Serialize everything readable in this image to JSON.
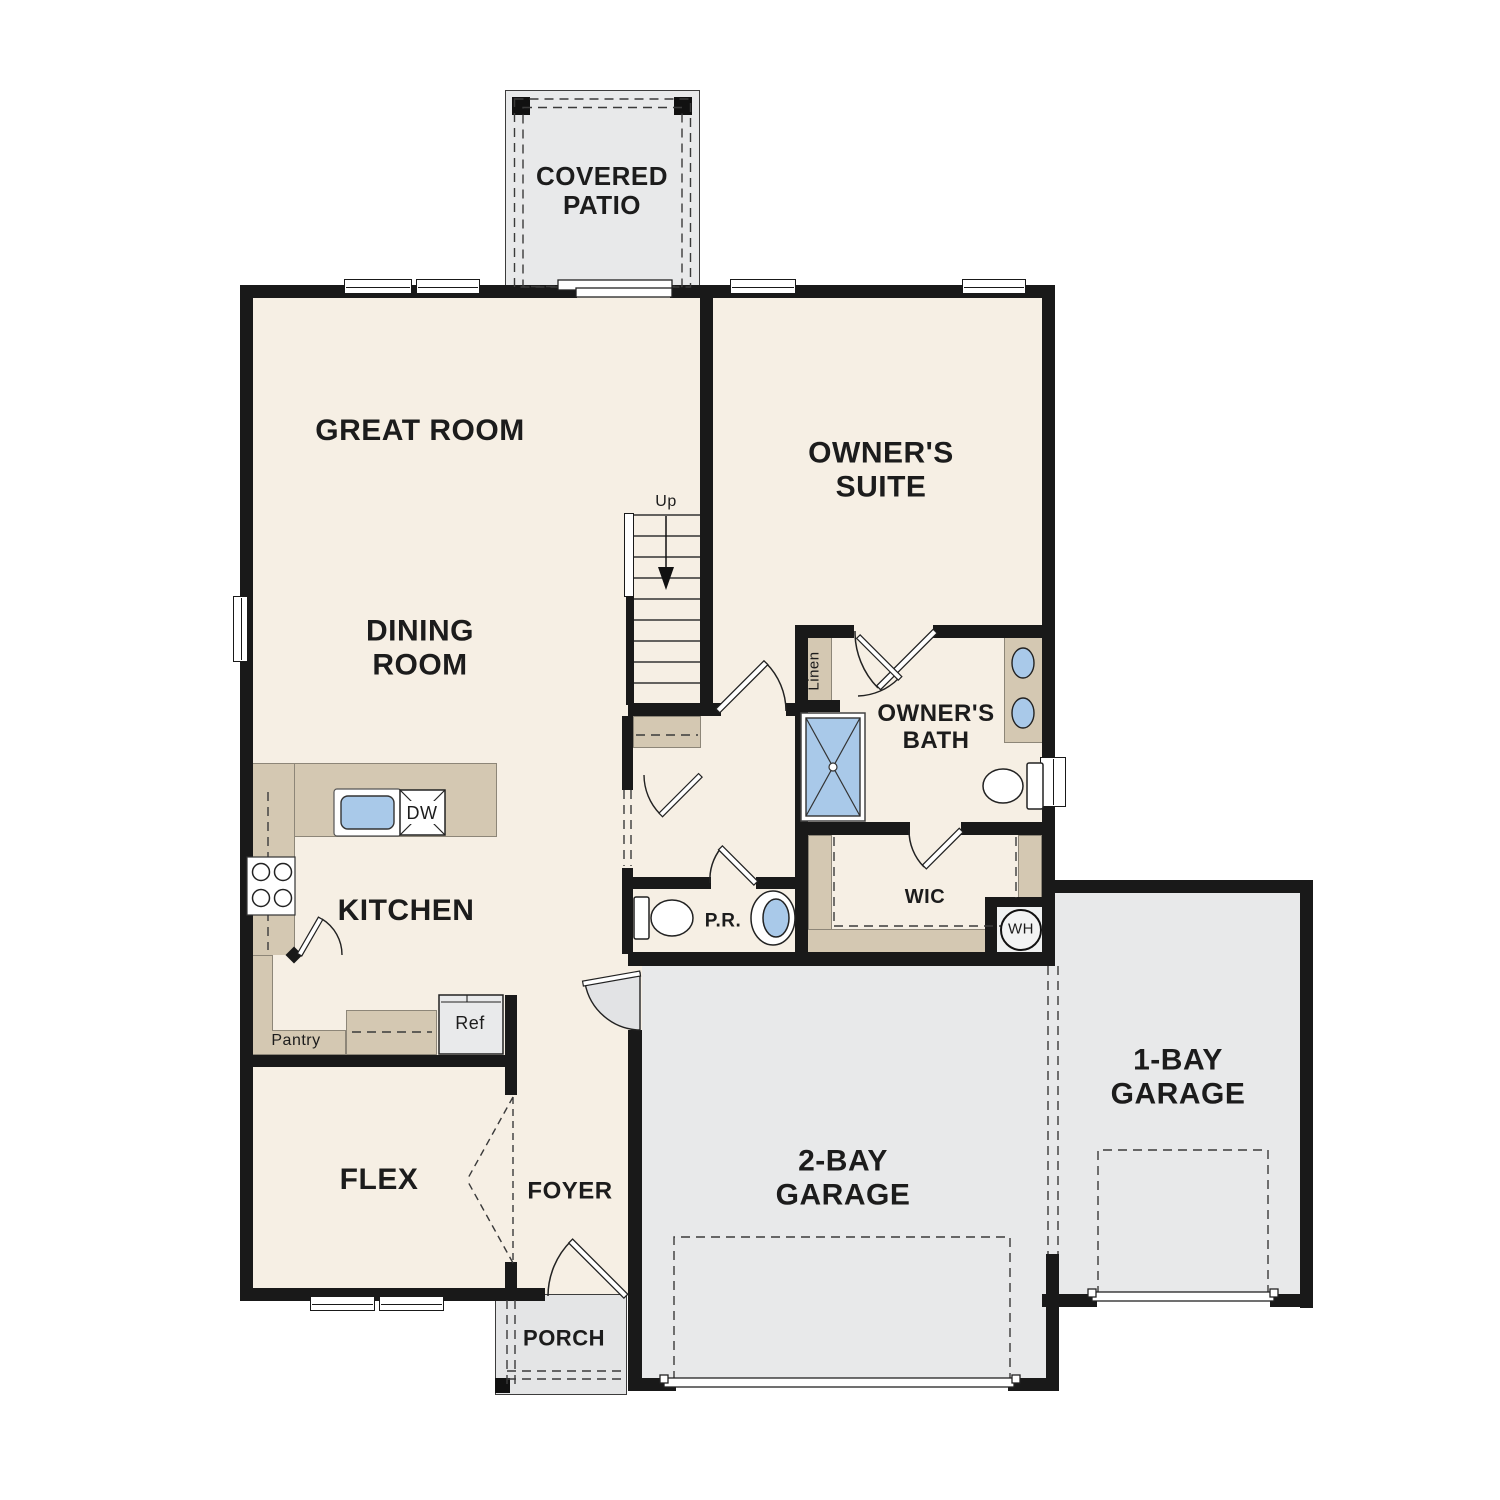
{
  "rooms": {
    "covered_patio": "COVERED\nPATIO",
    "great_room": "GREAT ROOM",
    "owners_suite": "OWNER'S\nSUITE",
    "dining_room": "DINING\nROOM",
    "owners_bath": "OWNER'S\nBATH",
    "kitchen": "KITCHEN",
    "wic": "WIC",
    "powder_room": "P.R.",
    "flex": "FLEX",
    "foyer": "FOYER",
    "porch": "PORCH",
    "two_bay_garage": "2-BAY\nGARAGE",
    "one_bay_garage": "1-BAY\nGARAGE"
  },
  "annotations": {
    "stairs_up": "Up",
    "linen": "Linen",
    "pantry": "Pantry",
    "dishwasher": "DW",
    "refrigerator": "Ref",
    "water_heater": "WH"
  },
  "colors": {
    "floor": "#f6efe4",
    "wall": "#191919",
    "garage_gray": "#e8e9ea",
    "cabinet_tan": "#d4c8b2",
    "fixture_blue": "#a9c9e9",
    "text": "#1c1c1c"
  }
}
